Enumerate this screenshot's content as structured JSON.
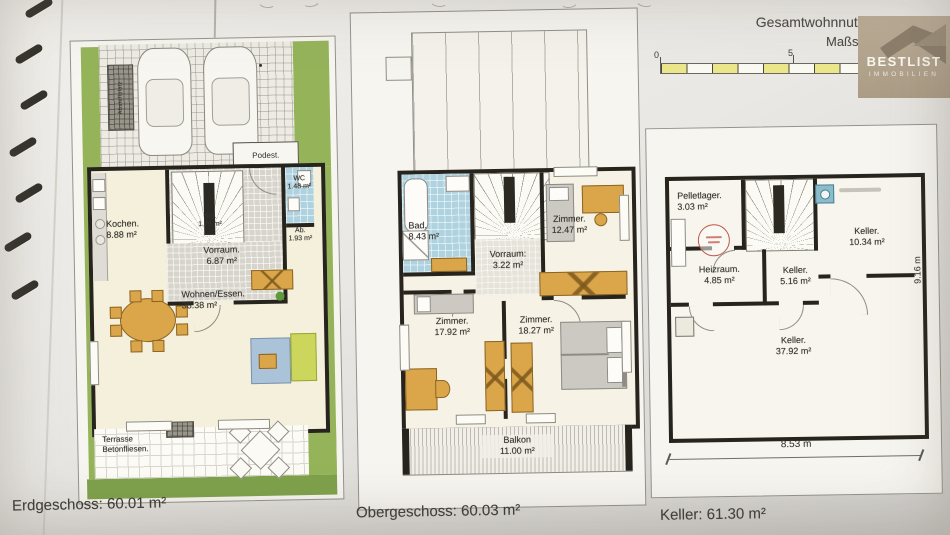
{
  "header": {
    "gesamt": "Gesamtwohnnutzfläche:",
    "mass": "Maßs",
    "scale0": "0",
    "scale5": "5"
  },
  "logo": {
    "title": "BESTLIST",
    "sub": "IMMOBILIEN"
  },
  "floors": {
    "eg": {
      "caption": "Erdgeschoss: 60.01 m²",
      "extra": {
        "podest": "Podest.",
        "abstell": "Abstellplatz",
        "terrasse1": "Terrasse",
        "terrasse2": "Betonfliesen."
      },
      "rooms": [
        {
          "name": "Kochen.",
          "area": "8.88 m²"
        },
        {
          "name": "Stg.",
          "area": "1.76 m²"
        },
        {
          "name": "Vorraum.",
          "area": "6.87 m²"
        },
        {
          "name": "WC",
          "area": "1.48 m²"
        },
        {
          "name": "Ab.",
          "area": "1.93 m²"
        },
        {
          "name": "Wohnen/Essen.",
          "area": "38.38 m²"
        }
      ]
    },
    "og": {
      "caption": "Obergeschoss: 60.03 m²",
      "rooms": [
        {
          "name": "Bad.",
          "area": "8.43 m²"
        },
        {
          "name": "Vorraum:",
          "area": "3.22 m²"
        },
        {
          "name": "Zimmer.",
          "area": "12.47 m²"
        },
        {
          "name": "Zimmer.",
          "area": "17.92 m²"
        },
        {
          "name": "Zimmer.",
          "area": "18.27 m²"
        },
        {
          "name": "Balkon",
          "area": "11.00 m²"
        }
      ]
    },
    "kg": {
      "caption": "Keller: 61.30 m²",
      "dimw": "8.53 m",
      "dimh": "9.16 m",
      "rooms": [
        {
          "name": "Pelletlager.",
          "area": "3.03 m²"
        },
        {
          "name": "Keller.",
          "area": "10.34 m²"
        },
        {
          "name": "Heizraum.",
          "area": "4.85 m²"
        },
        {
          "name": "Keller.",
          "area": "5.16 m²"
        },
        {
          "name": "Keller.",
          "area": "37.92 m²"
        }
      ]
    }
  },
  "colors": {
    "lawn": "#95b45a",
    "lawn_dark": "#7fa24c",
    "tile_blue": "#aed2df",
    "wood": "#dba64a",
    "wall": "#27241e",
    "scale_yellow": "#ebe78a",
    "logo_beige": "#b3a48e",
    "stamp_red": "#c0564b"
  }
}
